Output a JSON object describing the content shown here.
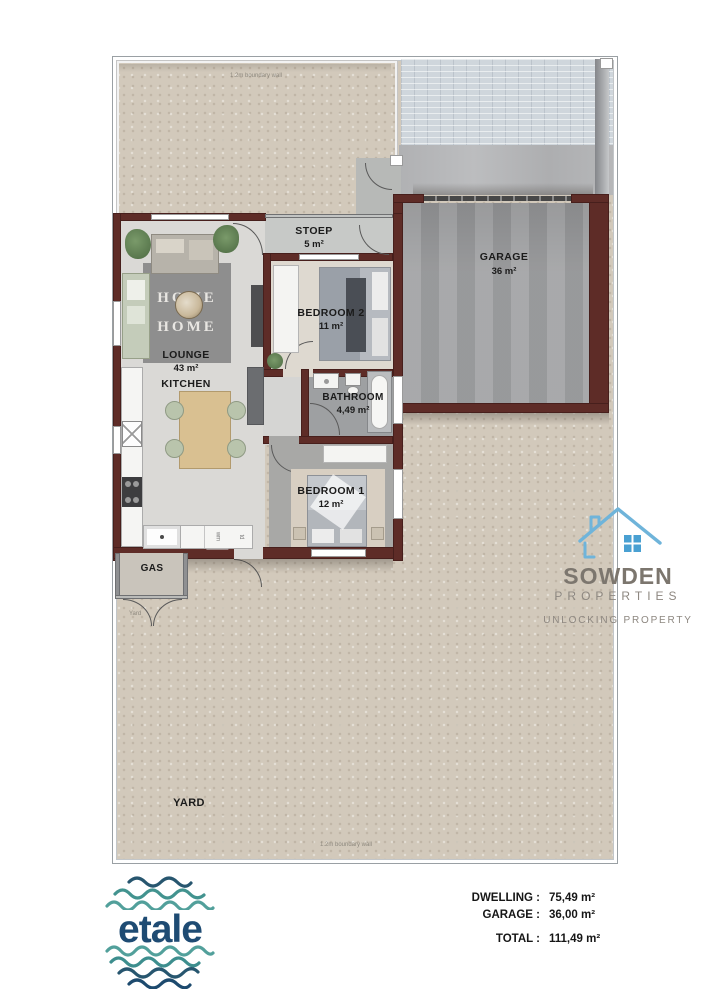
{
  "plan": {
    "boundary_wall_top": "1.2m boundary wall",
    "boundary_wall_bottom": "1.2m boundary wall",
    "rooms": {
      "stoep": {
        "name": "STOEP",
        "area": "5 m²"
      },
      "garage": {
        "name": "GARAGE",
        "area": "36 m²"
      },
      "bedroom2": {
        "name": "BEDROOM 2",
        "area": "11 m²"
      },
      "lounge": {
        "name": "LOUNGE",
        "area": "43 m²"
      },
      "kitchen": {
        "name": "KITCHEN"
      },
      "bathroom": {
        "name": "BATHROOM",
        "area": "4,49 m²"
      },
      "bedroom1": {
        "name": "BEDROOM 1",
        "area": "12 m²"
      },
      "gas": {
        "name": "GAS"
      },
      "yard": {
        "name": "YARD"
      }
    },
    "yard_small_label": "Yard",
    "appliances": {
      "washing_machine": "wm",
      "tumble_dryer": "td"
    },
    "lounge_rug": {
      "line1": "HOME",
      "line2": "HOME"
    }
  },
  "branding": {
    "sowden": {
      "name": "SOWDEN",
      "subtitle": "PROPERTIES",
      "tagline": "UNLOCKING PROPERTY"
    },
    "etale": {
      "name": "etale"
    }
  },
  "summary": {
    "dwelling": {
      "label": "DWELLING :",
      "value": "75,49 m²"
    },
    "garage": {
      "label": "GARAGE :",
      "value": "36,00 m²"
    },
    "total": {
      "label": "TOTAL :",
      "value": "111,49 m²"
    }
  },
  "colors": {
    "wall_maroon": "#5e2c27",
    "yard_beige": "#d2c9bb",
    "concrete_gray": "#a2a3a5",
    "paving_light": "#cfd6dc",
    "sowden_text": "#7c766e",
    "sowden_blue": "#6fb4da",
    "etale_navy": "#1e4b73",
    "etale_teal": "#3f9191"
  }
}
